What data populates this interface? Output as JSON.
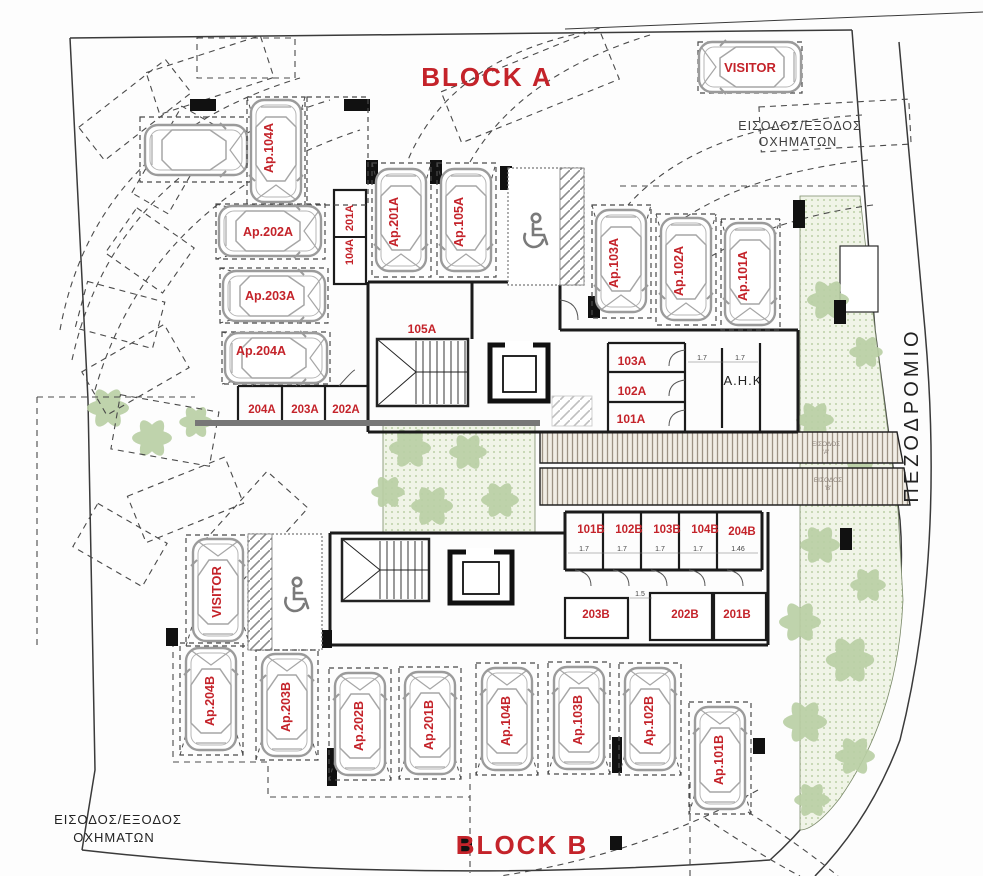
{
  "titles": {
    "block_a": "BLOCK A",
    "block_b": "BLOCK B"
  },
  "street": {
    "sidewalk": "ΠΕΖΟΔΡΟΜΙΟ"
  },
  "entrances": {
    "top_line1": "ΕΙΣΟΔΟΣ/ΕΞΟΔΟΣ",
    "top_line2": "ΟΧΗΜΑΤΩΝ",
    "bottom_line1": "ΕΙΣΟΔΟΣ/ΕΞΟΔΟΣ",
    "bottom_line2": "ΟΧΗΜΑΤΩΝ",
    "walk_a1": "ΕΙΣΟΔΟΣ",
    "walk_a2": "'Α'",
    "walk_b1": "ΕΙΣΟΔΟΣ",
    "walk_b2": "'Β'"
  },
  "parking": {
    "visitor_top": "VISITOR",
    "visitor_b": "VISITOR",
    "a104": "Ap.104A",
    "a202": "Ap.202A",
    "a203": "Ap.203A",
    "a204": "Ap.204A",
    "a201": "Ap.201A",
    "a105": "Ap.105A",
    "a103": "Ap.103A",
    "a102": "Ap.102A",
    "a101": "Ap.101A",
    "b204": "Ap.204B",
    "b203": "Ap.203B",
    "b202": "Ap.202B",
    "b201": "Ap.201B",
    "b104": "Ap.104B",
    "b103": "Ap.103B",
    "b102": "Ap.102B",
    "b101": "Ap.101B"
  },
  "rooms": {
    "s201a": "201A",
    "s104a": "104A",
    "s105a": "105A",
    "s204a": "204A",
    "s203a": "203A",
    "s202a": "202A",
    "s103a": "103A",
    "s102a": "102A",
    "s101a": "101A",
    "ahk": "A.H.K",
    "sb101": "101B",
    "sb102": "102B",
    "sb103": "103B",
    "sb104": "104B",
    "sb204": "204B",
    "sb203": "203B",
    "sb202": "202B",
    "sb201": "201B"
  },
  "dims": {
    "ahk_1": "1.7",
    "ahk_2": "1.7",
    "row_1": "1.7",
    "row_2": "1.7",
    "row_3": "1.7",
    "row_4": "1.7",
    "row_5": "1.46",
    "corr": "1.5"
  },
  "colors": {
    "label_red": "#c4232a",
    "wall_black": "#1b1b1b",
    "car_gray": "#9b9b9b",
    "leaf_green": "#b9cfa4",
    "bed_green": "#eef3e4",
    "walkway_hatch": "#9c9284"
  }
}
